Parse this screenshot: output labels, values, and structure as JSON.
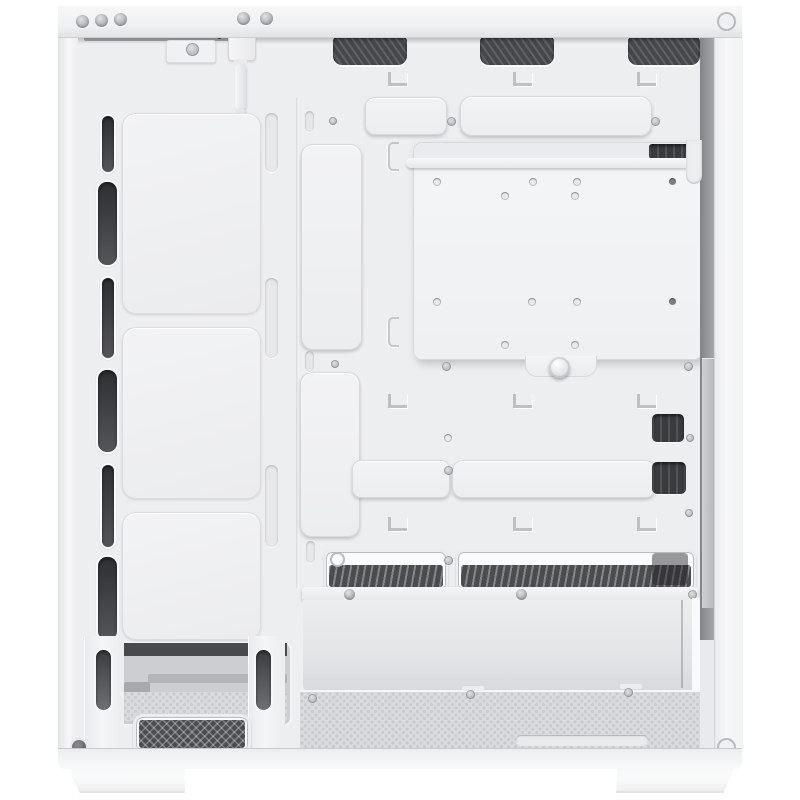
{
  "scene": {
    "subject": "White mid-tower PC case, open side view with side panel removed, empty interior",
    "setting": "studio product photo on plain white background",
    "visible_features": [
      "three top fan vent cutouts with dark mesh",
      "front fan mounting column with three blank fan plates and six dark vent slots",
      "motherboard tray with removable mounting plate held by a thumbscrew",
      "white cable cutout covers (two horizontal top, one vertical, one L-shaped, one lower horizontal)",
      "cable tie hooks on the tray",
      "PSU shroud with two mesh vent strips",
      "open PSU compartment with perforated bottom panel",
      "front bottom mesh intake and drive bay opening",
      "white front-panel cable hanging at top front",
      "two white case feet"
    ]
  },
  "palette": {
    "bg": "#ffffff",
    "shell": "#f2f3f5",
    "interior": "#edeef0",
    "panel-border": "#d7d8db",
    "vent": "#46474a",
    "slot": "#3a3b3e",
    "gap": "#8b8c90",
    "floor": "#dadbde",
    "floor-dot": "#c9cacb",
    "screw-ring": "#b9babd",
    "foot": "#fafbfc",
    "bright": "#f8f9fb",
    "shadow": "rgba(62,64,69,0.25)"
  },
  "structure": {
    "top_fan_vents": 3,
    "front_fan_positions": 3,
    "front_vent_slots": 6,
    "cable_cover_plates": 5,
    "cable_tie_hooks": 9,
    "plate_mounting_holes": 12,
    "case_feet": 2
  }
}
